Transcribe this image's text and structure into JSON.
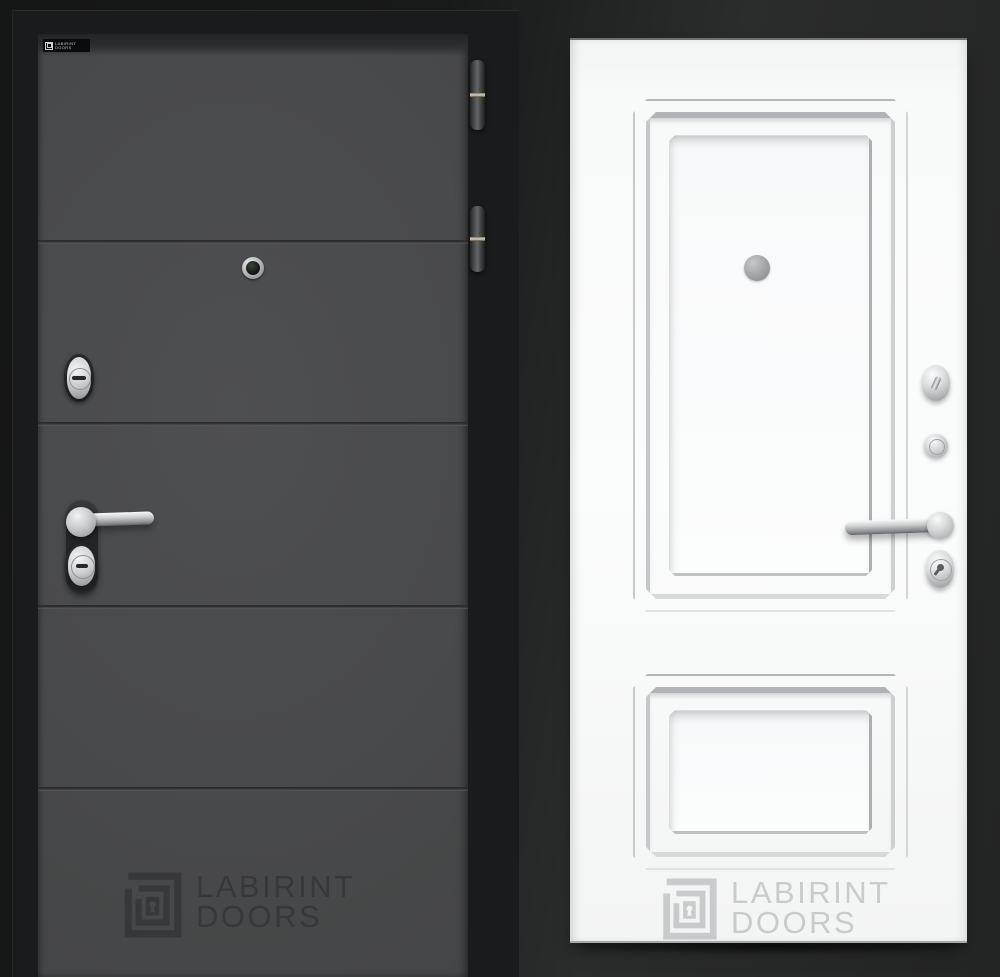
{
  "scene": {
    "brand": "LABIRINT DOORS",
    "background_color": "#1b1c1c"
  },
  "left_door": {
    "finish_color": "#4a4b4c",
    "frame_color": "#1a1b1c",
    "badge": {
      "line1": "LABIRINT",
      "line2": "DOORS"
    },
    "watermark": {
      "line1": "LABIRINT",
      "line2": "DOORS"
    },
    "hardware": {
      "hinge_count": 2,
      "items": [
        "hinge",
        "peephole",
        "cylinder-lock",
        "lever-handle",
        "keyhole-lock"
      ]
    }
  },
  "right_door": {
    "finish_color": "#f7f8f8",
    "watermark": {
      "line1": "LABIRINT",
      "line2": "DOORS"
    },
    "hardware": {
      "items": [
        "peephole-cover",
        "thumbturn",
        "lock-cylinder",
        "lever-handle",
        "keyhole-lock"
      ]
    }
  }
}
